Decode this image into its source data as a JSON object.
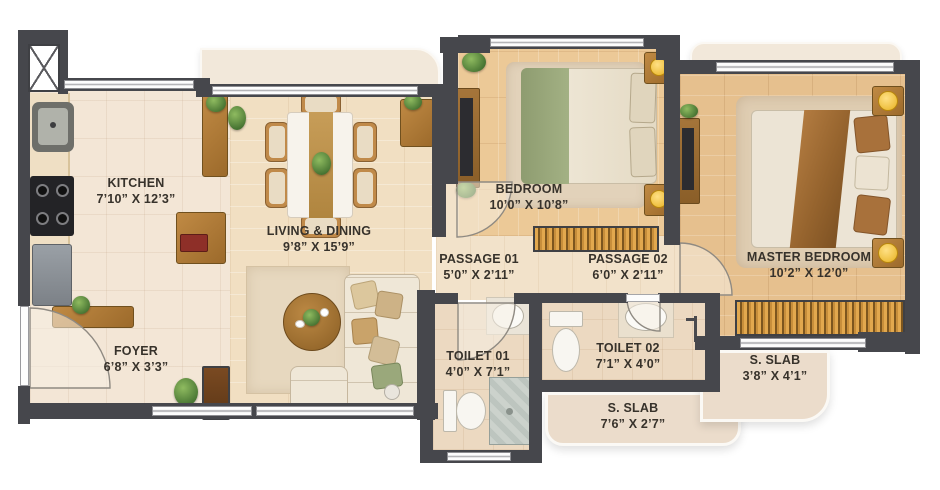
{
  "rooms": {
    "kitchen": {
      "name": "KITCHEN",
      "dims": "7’10” X 12’3”"
    },
    "living": {
      "name": "LIVING & DINING",
      "dims": "9’8” X 15’9”"
    },
    "foyer": {
      "name": "FOYER",
      "dims": "6’8” X 3’3”"
    },
    "bedroom": {
      "name": "BEDROOM",
      "dims": "10’0” X 10’8”"
    },
    "passage1": {
      "name": "PASSAGE 01",
      "dims": "5’0” X 2’11”"
    },
    "passage2": {
      "name": "PASSAGE 02",
      "dims": "6’0” X 2’11”"
    },
    "toilet1": {
      "name": "TOILET 01",
      "dims": "4’0” X 7’1”"
    },
    "toilet2": {
      "name": "TOILET 02",
      "dims": "7’1” X 4’0”"
    },
    "master": {
      "name": "MASTER BEDROOM",
      "dims": "10’2” X 12’0”"
    },
    "slab_bottom": {
      "name": "S. SLAB",
      "dims": "7’6” X 2’7”"
    },
    "slab_right": {
      "name": "S. SLAB",
      "dims": "3’8” X 4’1”"
    }
  },
  "palette": {
    "wall": "#46474c",
    "kitchen_tile": "#f3e6d6",
    "living_wood": "#f1dfc2",
    "bedroom_wood": "#ecc997",
    "master_wood": "#e6c08e",
    "toilet_floor": "#ecd9c1",
    "slab": "#ebdccb",
    "wardrobe_hatch": "#d89a3c",
    "label_text": "#37322b",
    "bed_green": "#96a478",
    "bed_brown": "#a8713b",
    "lamp_yellow": "#f2c44d"
  }
}
